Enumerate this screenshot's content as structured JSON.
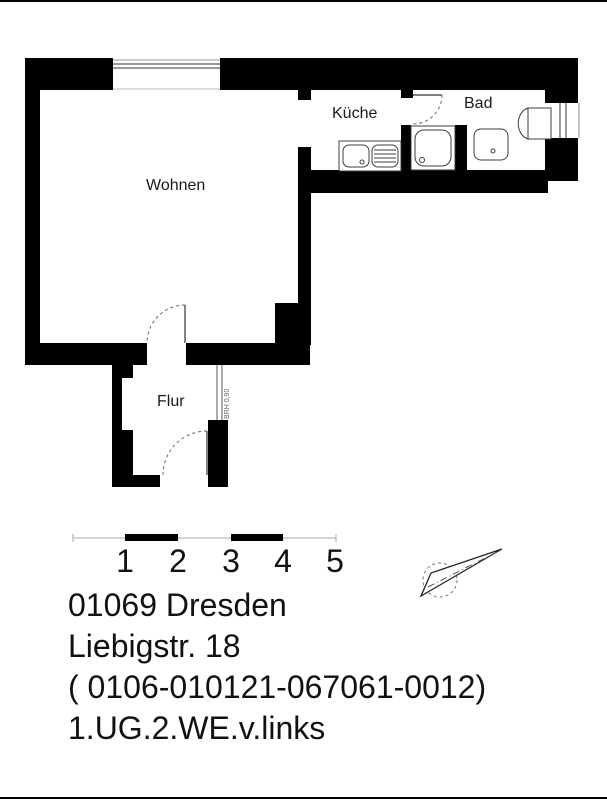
{
  "rooms": {
    "living": {
      "label": "Wohnen"
    },
    "kitchen": {
      "label": "Küche"
    },
    "bath": {
      "label": "Bad"
    },
    "hall": {
      "label": "Flur"
    }
  },
  "annotations": {
    "hall_window": "BRH 0,90"
  },
  "scale_bar": {
    "labels": [
      "1",
      "2",
      "3",
      "4",
      "5"
    ]
  },
  "address": {
    "city": "01069 Dresden",
    "street": "Liebigstr. 18",
    "reference": "( 0106-010121-067061-0012)",
    "unit": "1.UG.2.WE.v.links"
  },
  "colors": {
    "wall": "#000000",
    "fixture_line": "#3c3c3c",
    "text": "#111111"
  }
}
